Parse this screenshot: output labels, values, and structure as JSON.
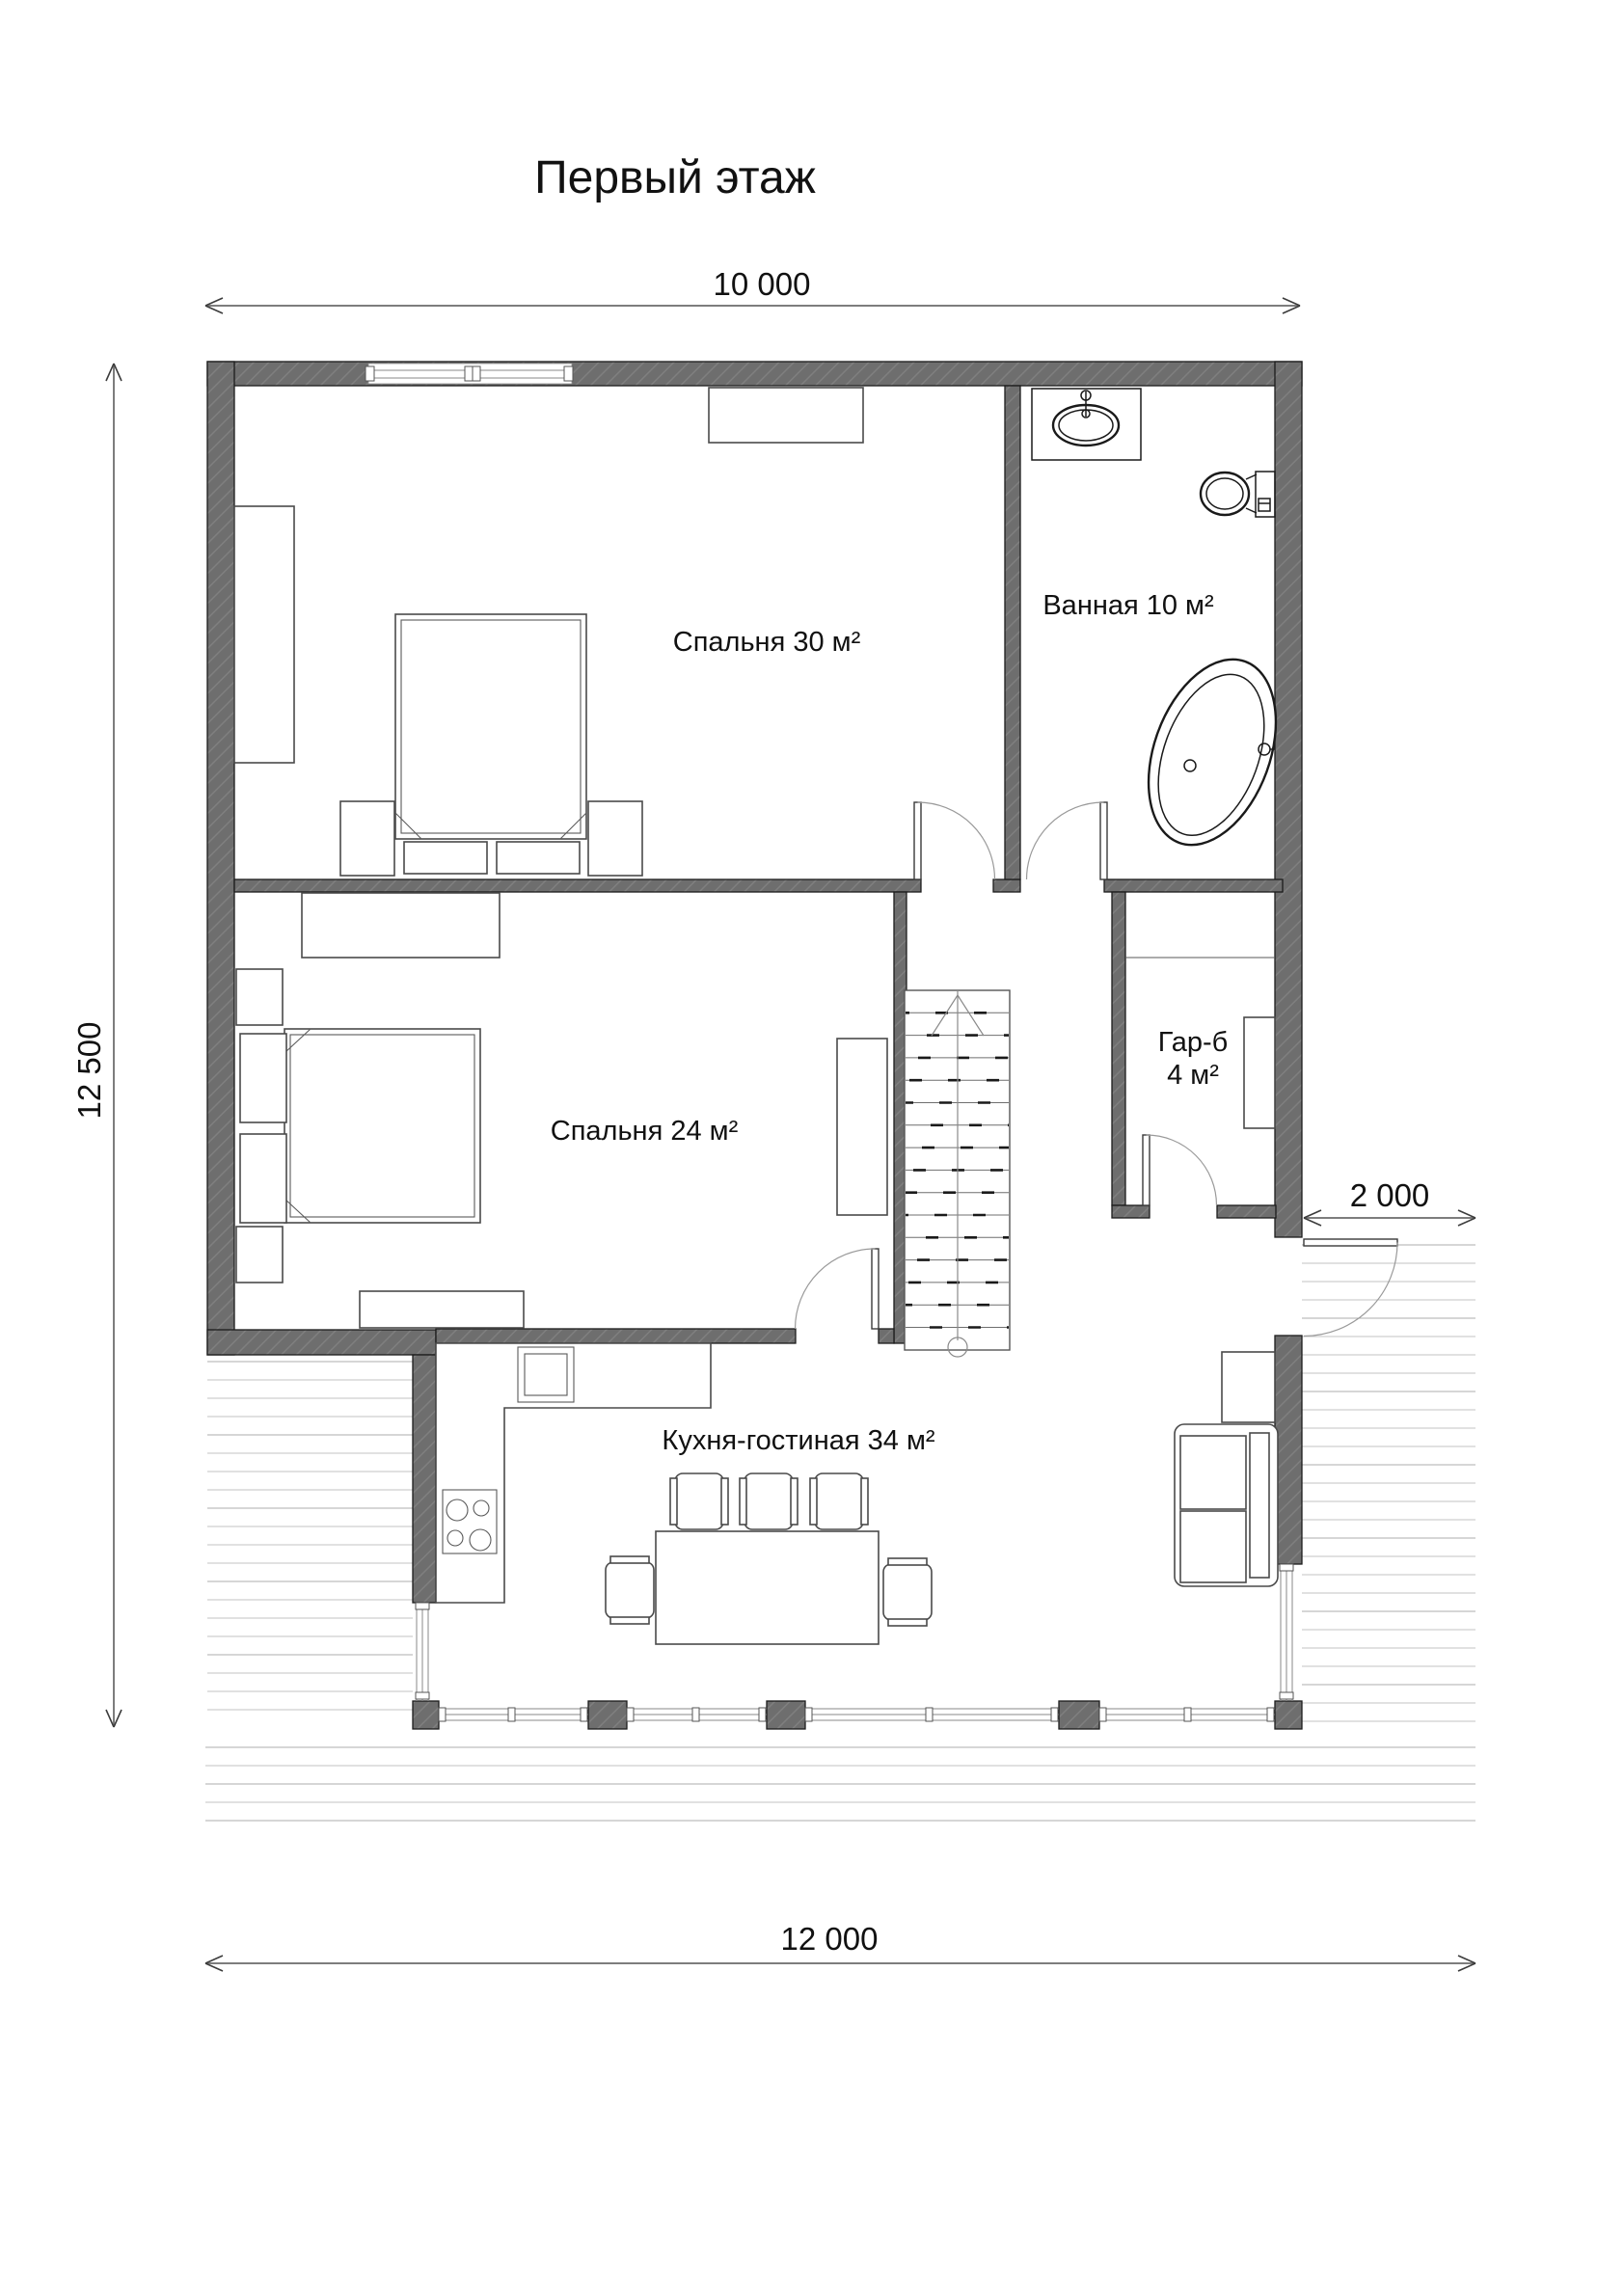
{
  "title": "Первый этаж",
  "rooms": {
    "bedroom30": "Спальня 30 м²",
    "bathroom": "Ванная 10 м²",
    "bedroom24": "Спальня 24 м²",
    "wardrobe_name": "Гар-б",
    "wardrobe_area": "4 м²",
    "kitchen": "Кухня-гостиная 34 м²"
  },
  "dimensions": {
    "width_top": "10 000",
    "height_left": "12 500",
    "terrace_right": "2 000",
    "width_bottom": "12 000"
  },
  "colors": {
    "wall_fill": "#6e6e6e",
    "wall_hatch": "#7f7f7f",
    "wall_outline": "#1c1c1c",
    "furniture_stroke": "#4a4a4a",
    "fixture_stroke": "#1a1a1a",
    "dimension_line": "#7d7d7d",
    "terrace_plank": "#c3c3c3",
    "text": "#111111"
  },
  "furniture_icons": [
    "double-bed-icon",
    "pillow-icon",
    "nightstand-icon",
    "wardrobe-icon",
    "closet-icon",
    "dresser-icon",
    "sink-vanity-icon",
    "toilet-icon",
    "bathtub-icon",
    "kitchen-counter-icon",
    "sink-icon",
    "stove-icon",
    "dining-table-icon",
    "chair-icon",
    "sofa-icon",
    "tv-stand-icon",
    "stairs-up-icon",
    "door-swing-icon",
    "window-icon"
  ]
}
